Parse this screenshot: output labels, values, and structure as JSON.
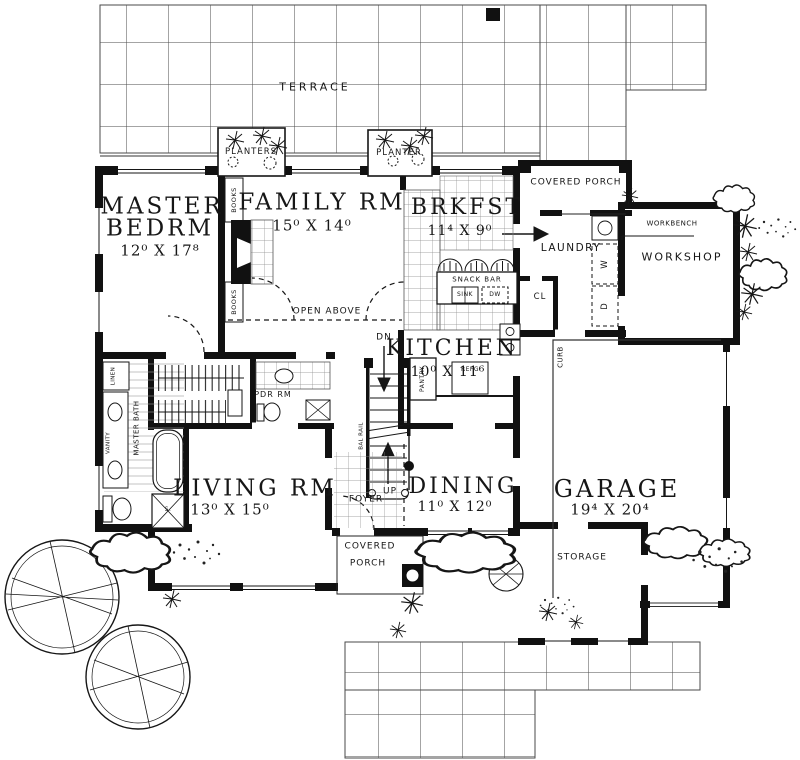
{
  "plan": {
    "outdoor": {
      "terrace": "TERRACE",
      "planter_left": "PLANTERS",
      "planter_right": "PLANTER",
      "covered_porch_top": "COVERED PORCH",
      "covered_porch_bottom_line1": "COVERED",
      "covered_porch_bottom_line2": "PORCH",
      "storage": "STORAGE"
    },
    "rooms": {
      "master_bedroom": {
        "name1": "MASTER",
        "name2": "BEDRM",
        "dim": "12⁰ X 17⁸"
      },
      "family_rm": {
        "name": "FAMILY RM",
        "dim": "15⁰ X 14⁰"
      },
      "brkfst": {
        "name": "BRKFST",
        "dim": "11⁴ X 9⁰"
      },
      "kitchen": {
        "name": "KITCHEN",
        "dim": "10⁰ X 11⁶"
      },
      "living_rm": {
        "name": "LIVING RM",
        "dim": "13⁰ X 15⁰"
      },
      "dining": {
        "name": "DINING",
        "dim": "11⁰ X 12⁰"
      },
      "garage": {
        "name": "GARAGE",
        "dim": "19⁴ X 20⁴"
      },
      "workshop": {
        "name": "WORKSHOP"
      },
      "laundry": {
        "name": "LAUNDRY"
      }
    },
    "annotations": {
      "workbench": "WORKBENCH",
      "open_above": "OPEN ABOVE",
      "snack_bar": "SNACK BAR",
      "sink": "SINK",
      "dw": "DW",
      "refg": "REFG",
      "pantry": "PANTRY",
      "foyer": "FOYER",
      "curb": "CURB",
      "cl": "CL",
      "dn": "DN",
      "up": "UP",
      "rail": "BAL RAIL",
      "washer": "W",
      "dryer": "D",
      "books_top": "BOOKS",
      "books_bottom": "BOOKS",
      "master_bath": "MASTER BATH",
      "vanity": "VANITY",
      "linen": "LINEN",
      "pdr_rm": "PDR RM",
      "shower": "S."
    },
    "colors": {
      "ink": "#161616",
      "paper": "#ffffff",
      "grid": "#4a4a4a"
    }
  }
}
